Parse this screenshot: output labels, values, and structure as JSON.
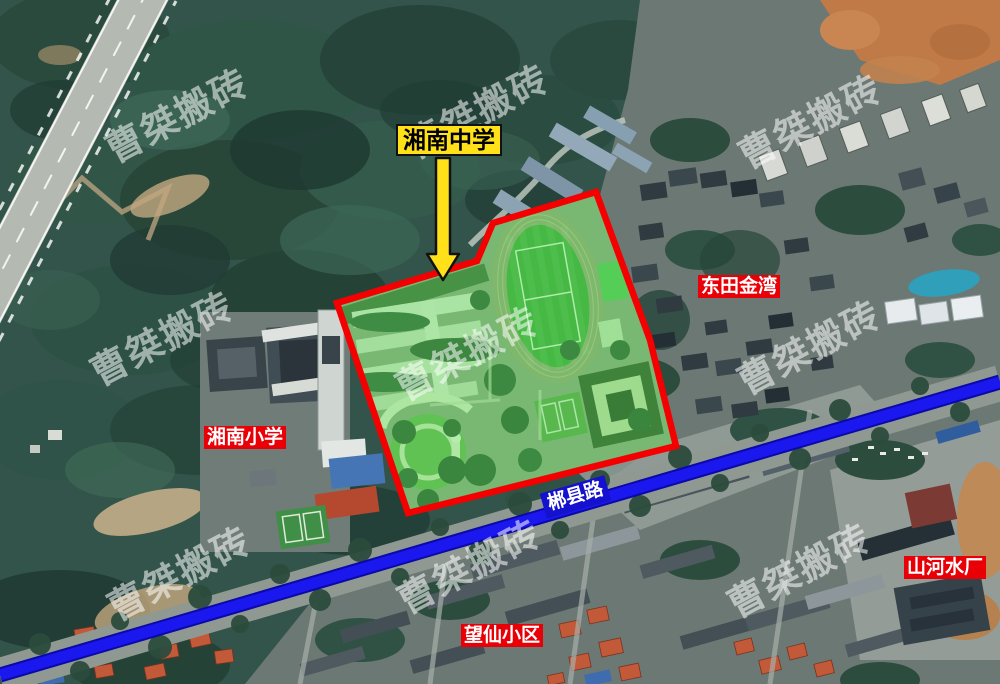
{
  "map": {
    "type": "satellite-annotation",
    "watermark": {
      "text": "曹桀搬砖",
      "color": "#ffffff"
    },
    "callout": {
      "text": "湘南中学",
      "bg": "#ffe11a",
      "border": "#111111"
    },
    "place_labels": [
      {
        "id": "dongtian-jinwan",
        "text": "东田金湾",
        "bg": "#e90007"
      },
      {
        "id": "xiangnan-primary",
        "text": "湘南小学",
        "bg": "#e90007"
      },
      {
        "id": "wangxian-estate",
        "text": "望仙小区",
        "bg": "#e90007"
      },
      {
        "id": "shanhe-water-plant",
        "text": "山河水厂",
        "bg": "#e90007"
      }
    ],
    "road_label": {
      "text": "郴县路",
      "bg": "#1512cf"
    },
    "colors": {
      "campus_boundary": "#f40000",
      "campus_highlight": "rgba(85,224,80,0.38)",
      "road_line": "#1a17ef",
      "label_red": "#e90007",
      "label_yellow": "#ffe11a"
    }
  }
}
